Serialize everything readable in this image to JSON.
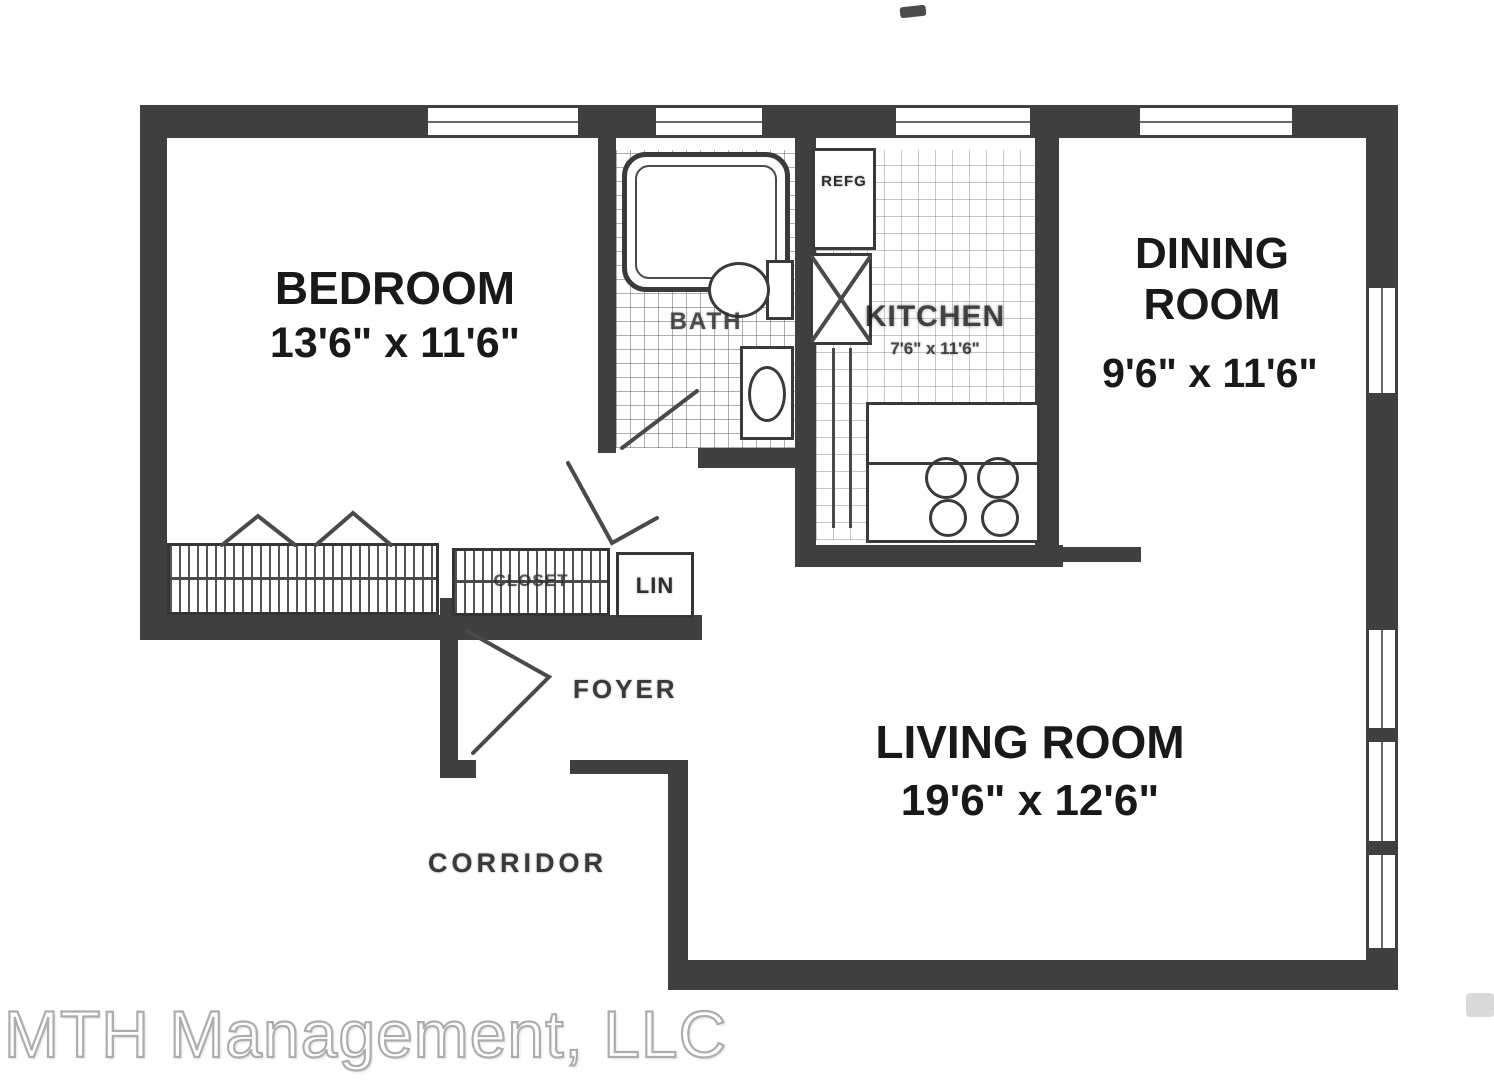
{
  "rooms": {
    "bedroom": {
      "name": "BEDROOM",
      "dimensions": "13'6\" x 11'6\""
    },
    "dining_room": {
      "name": "DINING ROOM",
      "dimensions": "9'6\" x 11'6\""
    },
    "living_room": {
      "name": "LIVING ROOM",
      "dimensions": "19'6\" x 12'6\""
    },
    "kitchen": {
      "name": "KITCHEN",
      "dimensions": "7'6\" x 11'6\""
    },
    "bathroom": {
      "name": "BATH"
    },
    "foyer": {
      "name": "FOYER"
    },
    "corridor": {
      "name": "CORRIDOR"
    }
  },
  "closets": {
    "coat_label": "CLOSET",
    "linen_label": "LIN"
  },
  "appliances": {
    "refrigerator_label": "REFG"
  },
  "watermark": "MTH Management, LLC",
  "colors": {
    "wall": "#3f3f3f",
    "line": "#4a4a4a",
    "watermark_outline": "#adadad"
  }
}
